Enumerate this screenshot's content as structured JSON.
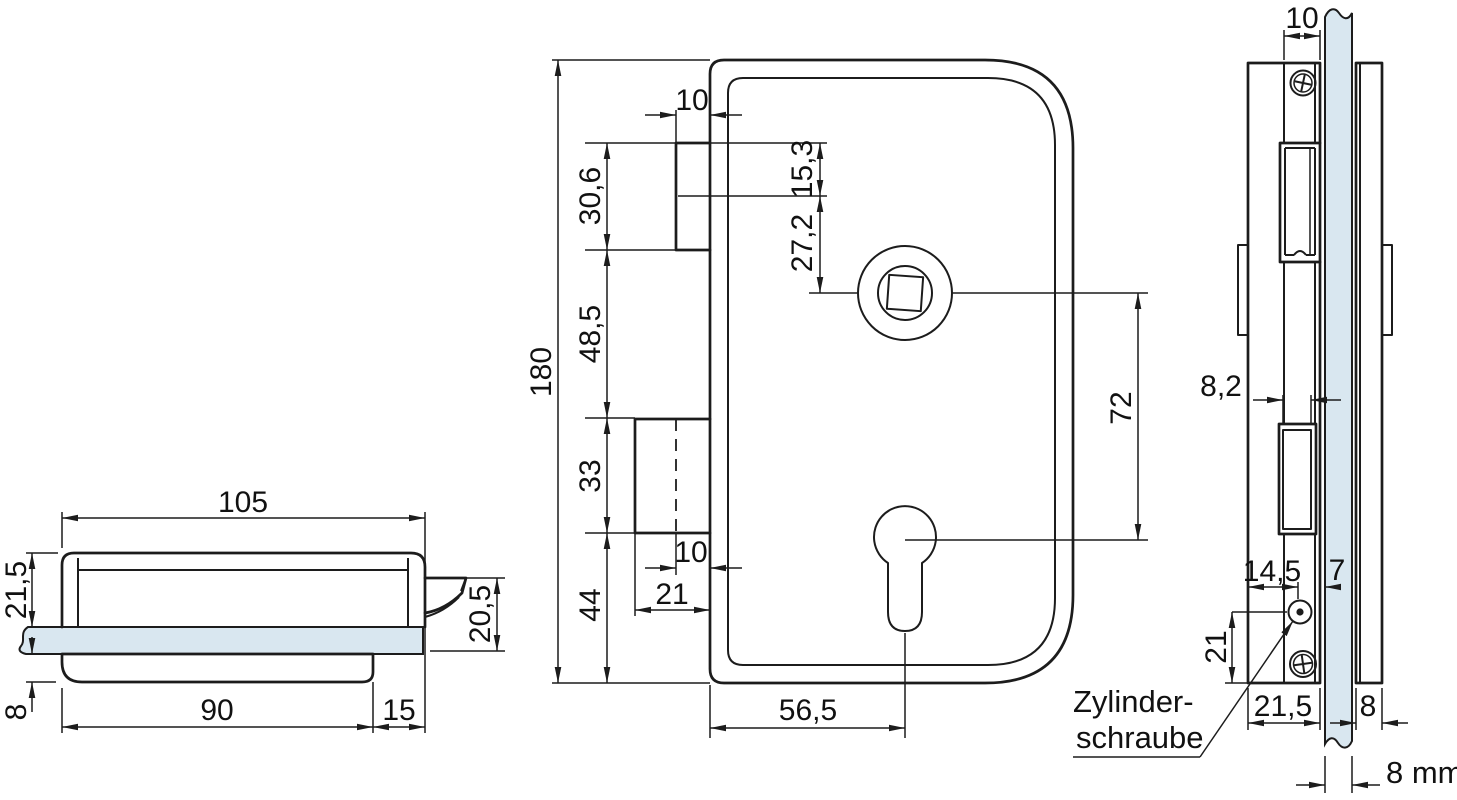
{
  "title": "Glass door lock technical drawing",
  "colors": {
    "line": "#1c1c1c",
    "glass": "#d9e7f0",
    "background": "#ffffff"
  },
  "views": {
    "side": {
      "dims": {
        "w105": "105",
        "h215": "21,5",
        "h205": "20,5",
        "h8": "8",
        "w90": "90",
        "w15": "15"
      }
    },
    "front": {
      "dims": {
        "h180": "180",
        "tab10": "10",
        "s306": "30,6",
        "s485": "48,5",
        "s33": "33",
        "s44": "44",
        "k153": "15,3",
        "k272": "27,2",
        "v72": "72",
        "b10": "10",
        "b21": "21",
        "b565": "56,5"
      }
    },
    "edge": {
      "dims": {
        "t10": "10",
        "s82": "8,2",
        "w145": "14,5",
        "w7": "7",
        "h21": "21",
        "w215": "21,5",
        "w8": "8",
        "glass": "8 mm"
      },
      "label": {
        "line1": "Zylinder-",
        "line2": "schraube"
      }
    }
  }
}
